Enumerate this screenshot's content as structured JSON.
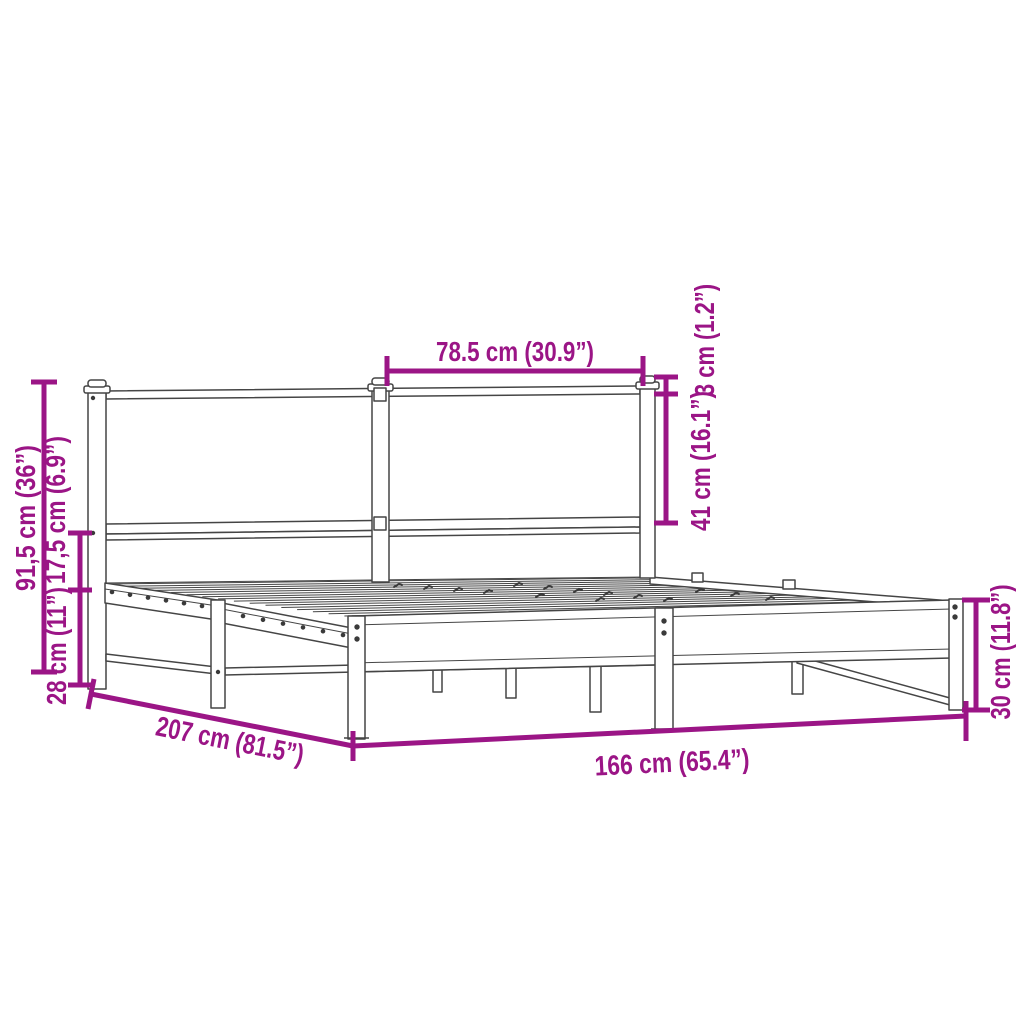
{
  "diagram": {
    "background_color": "#ffffff",
    "line_art_color": "#454545",
    "accent_color": "#9B1586",
    "labels": {
      "panel_width": "78.5 cm (30.9”)",
      "cap_height": "3 cm (1.2”)",
      "headboard_height": "41 cm (16.1”)",
      "total_height": "91,5 cm (36”)",
      "clearance_height": "17,5 cm (6.9”)",
      "base_height": "28 cm (11”)",
      "length": "207 cm (81.5”)",
      "width": "166 cm (65.4”)",
      "frame_side_height": "30 cm (11.8”)"
    }
  }
}
